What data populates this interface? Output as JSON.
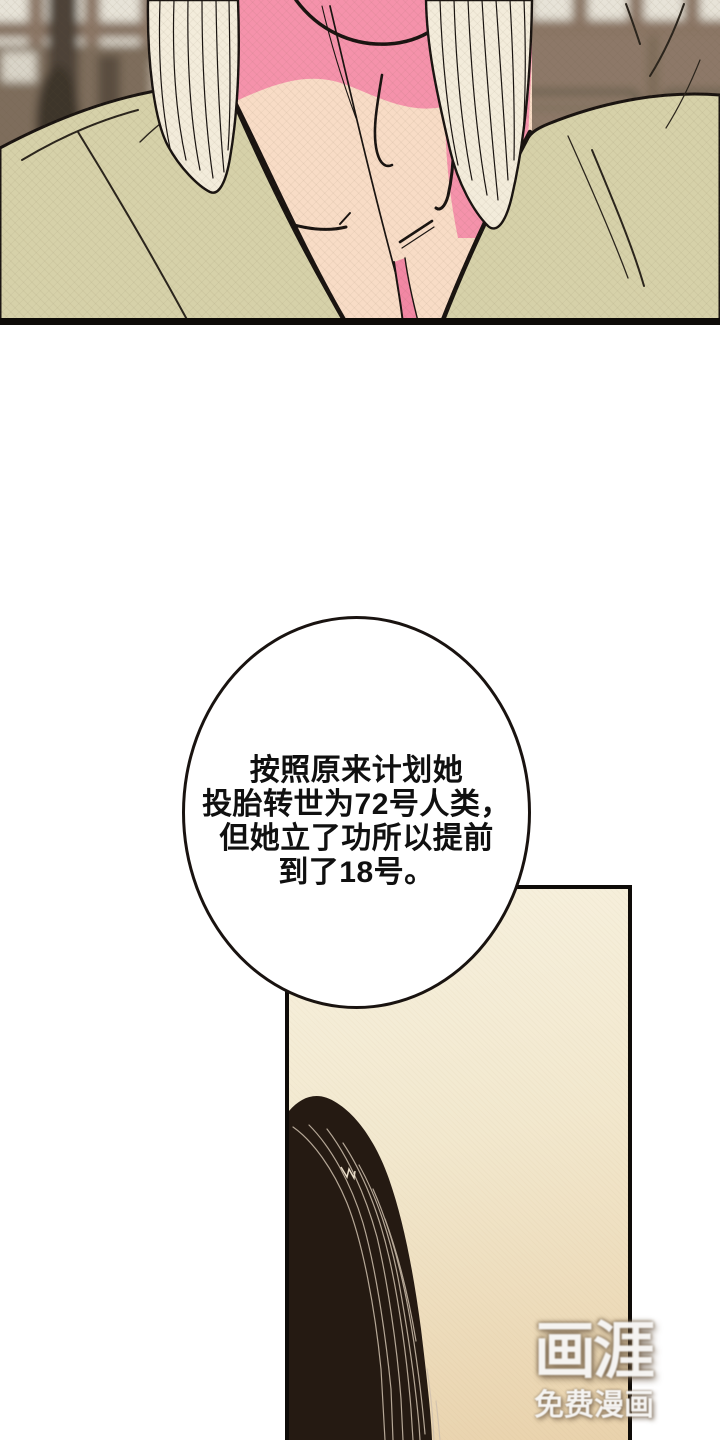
{
  "speech_bubble": {
    "lines": [
      "按照原来计划她",
      "投胎转世为72号人类，",
      "但她立了功所以提前",
      "到了18号。"
    ]
  },
  "watermark": {
    "logo": "画涯",
    "subtitle": "免费漫画"
  },
  "colors": {
    "ink": "#191310",
    "robe": "#d6d1a9",
    "skin": "#f8dcc6",
    "blush": "#f592ab",
    "blush-deep": "#f287a4",
    "hair-light": "#f3ecdb",
    "hair-dark": "#251a12",
    "hair-strand-light": "#cfc0ae",
    "panel-cream-top": "#f7f1df",
    "panel-cream-mid": "#f2e8ce",
    "panel-cream-bottom": "#e9d2ac",
    "bubble-fill": "#ffffff",
    "bg-brown": "#95806e",
    "bg-brown-dark": "#4e4337",
    "bg-lattice": "#e7e3d8",
    "bg-frame": "#8a7563",
    "border-black": "#0e0b08"
  }
}
